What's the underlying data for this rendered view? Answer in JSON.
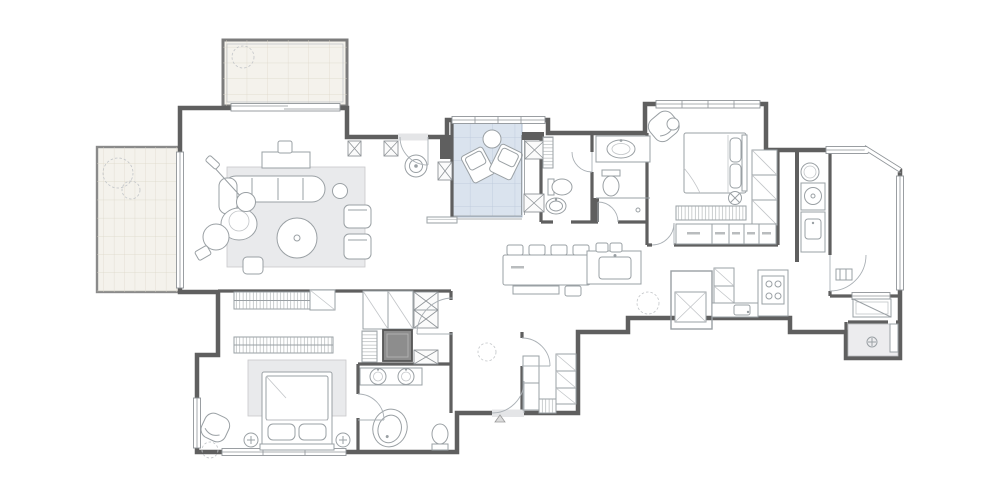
{
  "annotations": {
    "entrance_label": "Entrance",
    "level_marker": "+15",
    "water_heater_label": "热水器",
    "meter_box_label": "强弱电箱"
  },
  "colors": {
    "background": "#ffffff",
    "wall": "#5f5f5f",
    "floor": "#e4e5e7",
    "terrace_floor": "#f4f2ec",
    "terrace_grid": "#dcd6c8",
    "courtyard_floor": "#dae3ee",
    "courtyard_grid": "#bac8da",
    "furniture_line": "#9aa0a4",
    "dark_fixture": "#8d8d8d"
  }
}
